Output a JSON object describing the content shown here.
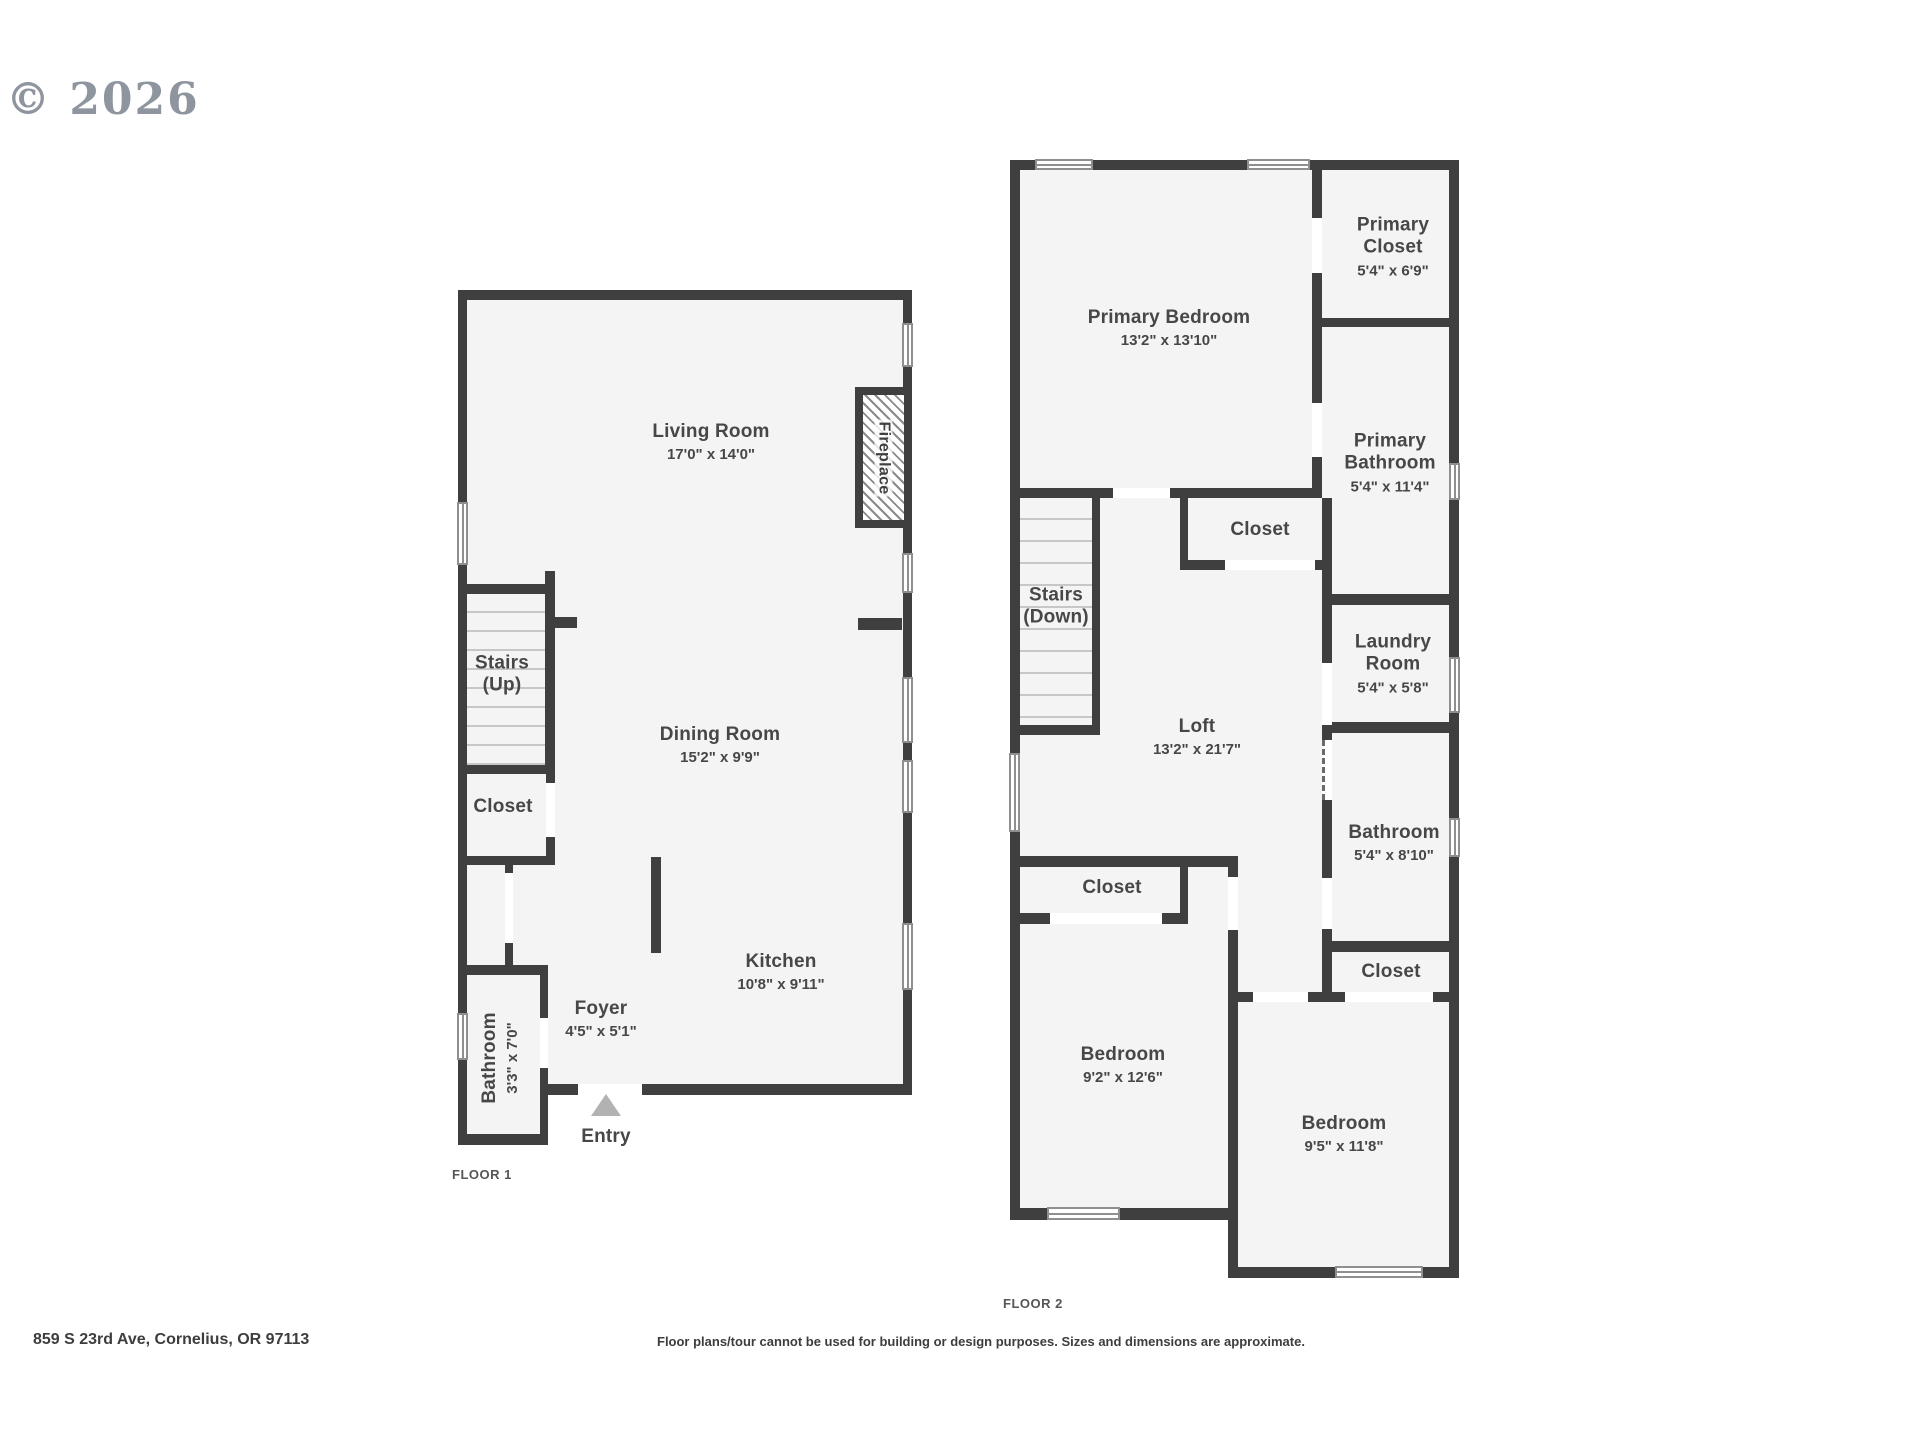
{
  "copyright": "© 2026",
  "address": "859 S 23rd Ave, Cornelius, OR 97113",
  "disclaimer": "Floor plans/tour cannot be used for building or design purposes. Sizes and dimensions are approximate.",
  "colors": {
    "wall": "#3f3f3f",
    "floor": "#f4f4f4",
    "tread": "#c7c7c7",
    "window_frame": "#8f8f8f",
    "entry_arrow": "#b2b2b2",
    "label": "#474747"
  },
  "floors": [
    {
      "label": "FLOOR 1",
      "fills": [
        [
          458,
          290,
          454,
          805
        ],
        [
          458,
          965,
          90,
          180
        ]
      ],
      "stairs": [
        {
          "x": 467,
          "y": 594,
          "w": 78,
          "h": 171,
          "spacing": 19
        }
      ],
      "walls": [
        [
          458,
          290,
          454,
          10
        ],
        [
          458,
          290,
          9,
          855
        ],
        [
          903,
          290,
          9,
          805
        ],
        [
          548,
          1084,
          364,
          11
        ],
        [
          458,
          584,
          89,
          10
        ],
        [
          545,
          571,
          10,
          203
        ],
        [
          555,
          617,
          22,
          11
        ],
        [
          458,
          765,
          97,
          9
        ],
        [
          546,
          774,
          9,
          91
        ],
        [
          458,
          856,
          97,
          9
        ],
        [
          505,
          865,
          8,
          100
        ],
        [
          458,
          965,
          90,
          10
        ],
        [
          540,
          975,
          8,
          170
        ],
        [
          458,
          1134,
          90,
          11
        ],
        [
          651,
          857,
          10,
          96
        ],
        [
          858,
          618,
          44,
          12
        ]
      ],
      "windows": [
        [
          457,
          502,
          11,
          63,
          "v"
        ],
        [
          457,
          1013,
          11,
          47,
          "v"
        ],
        [
          902,
          323,
          11,
          44,
          "v"
        ],
        [
          902,
          553,
          11,
          40,
          "v"
        ],
        [
          902,
          677,
          11,
          66,
          "v"
        ],
        [
          902,
          760,
          11,
          53,
          "v"
        ],
        [
          902,
          923,
          11,
          67,
          "v"
        ]
      ],
      "doors": [
        [
          546,
          783,
          9,
          54
        ],
        [
          505,
          873,
          8,
          70
        ],
        [
          540,
          1018,
          8,
          50
        ],
        [
          578,
          1084,
          64,
          11
        ]
      ],
      "dashed_doors": [],
      "features": [
        {
          "type": "fireplace",
          "label": "Fireplace",
          "x": 855,
          "y": 387,
          "w": 57,
          "h": 141
        },
        {
          "type": "entry-arrow",
          "x": 591,
          "y": 1094,
          "w": 31,
          "h": 22
        }
      ],
      "rooms": [
        {
          "name": "Living Room",
          "dims": "17'0\" x 14'0\"",
          "x": 711,
          "y": 442
        },
        {
          "name": "Dining Room",
          "dims": "15'2\" x 9'9\"",
          "x": 720,
          "y": 745
        },
        {
          "name": "Kitchen",
          "dims": "10'8\" x 9'11\"",
          "x": 781,
          "y": 972
        },
        {
          "name": "Foyer",
          "dims": "4'5\" x 5'1\"",
          "x": 601,
          "y": 1019
        },
        {
          "name": "Stairs\n(Up)",
          "x": 502,
          "y": 675
        },
        {
          "name": "Closet",
          "x": 503,
          "y": 807
        },
        {
          "name": "Bathroom",
          "dims": "3'3\" x 7'0\"",
          "x": 500,
          "y": 1058,
          "rotate": -90
        },
        {
          "name": "Entry",
          "x": 606,
          "y": 1137
        }
      ]
    },
    {
      "label": "FLOOR 2",
      "fills": [
        [
          1010,
          160,
          448,
          1060
        ],
        [
          1228,
          992,
          231,
          286
        ]
      ],
      "stairs": [
        {
          "x": 1020,
          "y": 498,
          "w": 72,
          "h": 227,
          "spacing": 22
        }
      ],
      "walls": [
        [
          1010,
          160,
          448,
          10
        ],
        [
          1010,
          160,
          10,
          1060
        ],
        [
          1449,
          160,
          10,
          1118
        ],
        [
          1010,
          1208,
          228,
          12
        ],
        [
          1228,
          1267,
          231,
          11
        ],
        [
          1228,
          992,
          10,
          286
        ],
        [
          1010,
          488,
          312,
          10
        ],
        [
          1312,
          170,
          10,
          328
        ],
        [
          1322,
          318,
          136,
          9
        ],
        [
          1322,
          594,
          136,
          11
        ],
        [
          1322,
          498,
          10,
          235
        ],
        [
          1322,
          722,
          136,
          11
        ],
        [
          1322,
          733,
          10,
          219
        ],
        [
          1322,
          941,
          136,
          11
        ],
        [
          1322,
          952,
          10,
          50
        ],
        [
          1228,
          992,
          231,
          10
        ],
        [
          1180,
          489,
          8,
          81
        ],
        [
          1180,
          560,
          152,
          10
        ],
        [
          1092,
          489,
          8,
          246
        ],
        [
          1010,
          725,
          90,
          10
        ],
        [
          1010,
          856,
          228,
          11
        ],
        [
          1180,
          866,
          8,
          56
        ],
        [
          1010,
          913,
          178,
          11
        ],
        [
          1228,
          856,
          10,
          136
        ]
      ],
      "windows": [
        [
          1035,
          159,
          58,
          11,
          "h"
        ],
        [
          1247,
          159,
          63,
          11,
          "h"
        ],
        [
          1009,
          753,
          11,
          79,
          "v"
        ],
        [
          1449,
          463,
          11,
          37,
          "v"
        ],
        [
          1449,
          657,
          11,
          56,
          "v"
        ],
        [
          1449,
          818,
          11,
          39,
          "v"
        ],
        [
          1047,
          1207,
          73,
          13,
          "h"
        ],
        [
          1335,
          1266,
          88,
          12,
          "h"
        ]
      ],
      "doors": [
        [
          1113,
          488,
          57,
          10
        ],
        [
          1312,
          218,
          10,
          55
        ],
        [
          1312,
          403,
          10,
          54
        ],
        [
          1225,
          560,
          90,
          10
        ],
        [
          1322,
          663,
          10,
          62
        ],
        [
          1322,
          878,
          10,
          51
        ],
        [
          1050,
          913,
          112,
          11
        ],
        [
          1228,
          877,
          10,
          53
        ],
        [
          1253,
          992,
          55,
          10
        ],
        [
          1345,
          992,
          88,
          10
        ]
      ],
      "dashed_doors": [
        [
          1322,
          740,
          10,
          60
        ]
      ],
      "features": [],
      "rooms": [
        {
          "name": "Primary Bedroom",
          "dims": "13'2\" x 13'10\"",
          "x": 1169,
          "y": 328
        },
        {
          "name": "Primary\nCloset",
          "dims": "5'4\" x 6'9\"",
          "x": 1393,
          "y": 247
        },
        {
          "name": "Primary\nBathroom",
          "dims": "5'4\" x 11'4\"",
          "x": 1390,
          "y": 463
        },
        {
          "name": "Closet",
          "x": 1260,
          "y": 530
        },
        {
          "name": "Stairs\n(Down)",
          "x": 1056,
          "y": 607
        },
        {
          "name": "Laundry\nRoom",
          "dims": "5'4\" x 5'8\"",
          "x": 1393,
          "y": 664
        },
        {
          "name": "Loft",
          "dims": "13'2\" x 21'7\"",
          "x": 1197,
          "y": 737
        },
        {
          "name": "Bathroom",
          "dims": "5'4\" x 8'10\"",
          "x": 1394,
          "y": 843
        },
        {
          "name": "Closet",
          "x": 1112,
          "y": 888
        },
        {
          "name": "Closet",
          "x": 1391,
          "y": 972
        },
        {
          "name": "Bedroom",
          "dims": "9'2\" x 12'6\"",
          "x": 1123,
          "y": 1065
        },
        {
          "name": "Bedroom",
          "dims": "9'5\" x 11'8\"",
          "x": 1344,
          "y": 1134
        }
      ]
    }
  ]
}
